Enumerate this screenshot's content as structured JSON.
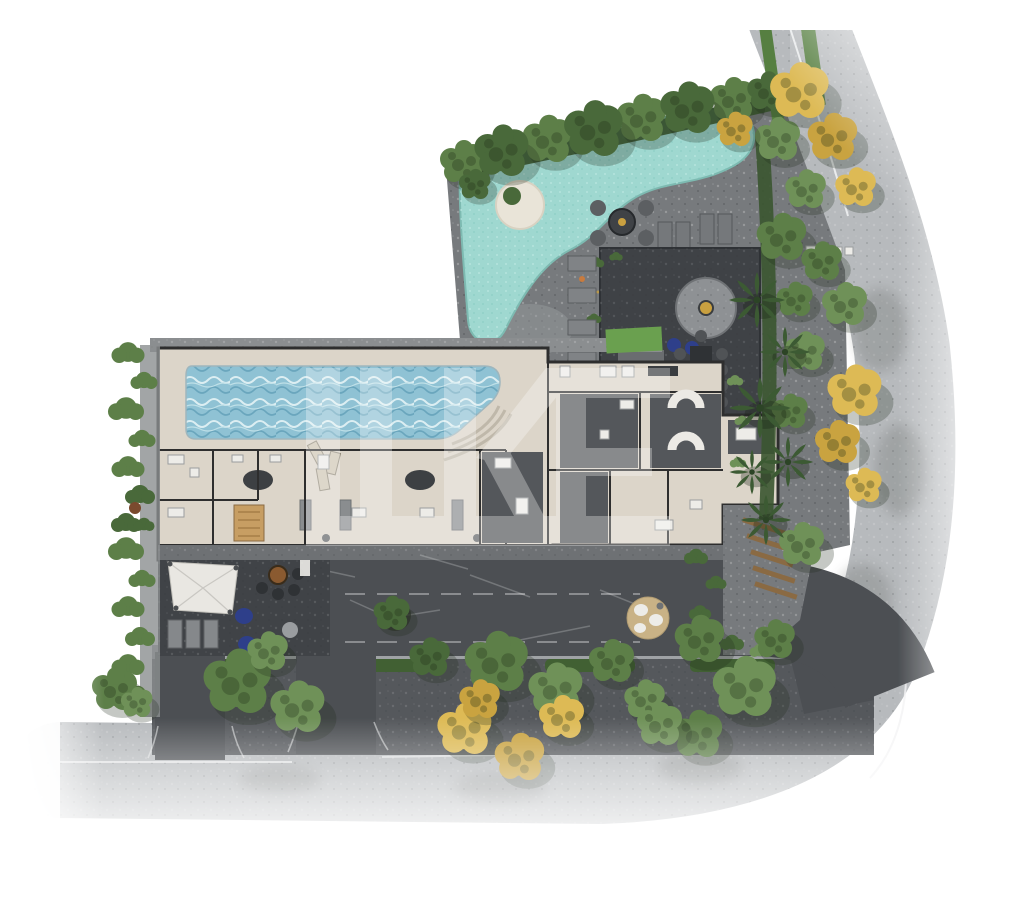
{
  "meta": {
    "description": "Aerial architectural site-plan rendering of a residential development with pools, amenity decks, gardens and perimeter streets",
    "view": "top-down"
  },
  "watermark": {
    "letters": "LIKE",
    "color": "#ffffff",
    "opacity": 0.3
  },
  "palette": {
    "canvas_bg": "#ffffff",
    "road": "#b7babd",
    "road_dark": "#4c4f53",
    "verge": "#55585c",
    "sidewalk": "#9fa2a5",
    "plaza": "#777a7d",
    "plaza_dark": "#3f4246",
    "terrace": "#404347",
    "mid_pavement": "#6e7174",
    "building_floor": "#dcd5c9",
    "building_wall": "#2e2e2e",
    "room_dark": "#54575b",
    "lagoon": "#9fd8d0",
    "lagoon_light": "#c6ece6",
    "lap_pool": "#8fc2d4",
    "lap_pool_wave": "#dceef2",
    "deck_stone": "#8b8e90",
    "grass": "#6aa04f",
    "grass_dark": "#567f41",
    "tree_green_1": "#5d7f48",
    "tree_green_2": "#49693a",
    "tree_green_3": "#6f9158",
    "tree_yellow": "#ddba55",
    "tree_yellow_2": "#c9a340",
    "hedge": "#416033",
    "palm": "#3c5a33",
    "sand": "#c9b286",
    "wood": "#c79e63",
    "navy": "#2e3f8a",
    "gold": "#c9a040",
    "white_line": "#f2f3f4",
    "fixture_white": "#edece8"
  },
  "areas": {
    "amenities_north": [
      "lagoon-pool",
      "pool-island",
      "stone-plaza",
      "fire-pit",
      "outdoor-lounge",
      "stone-fire-circle",
      "outdoor-dining",
      "bar-counter",
      "sun-loungers"
    ],
    "building": [
      "lap-pool",
      "pool-deck",
      "sauna",
      "locker-rooms",
      "lounge-rooms",
      "stairs",
      "annex"
    ],
    "south": [
      "drop-off-drive",
      "amenity-terrace",
      "canopy-tent",
      "terrace-fire-pit",
      "bean-bags"
    ],
    "east": [
      "garden-path",
      "boardwalk-steps",
      "sand-lounge",
      "planting-beds",
      "palm-trees"
    ],
    "streetscape": [
      "perimeter-road",
      "access-street",
      "sidewalk",
      "street-trees",
      "hedges",
      "driveways"
    ]
  }
}
